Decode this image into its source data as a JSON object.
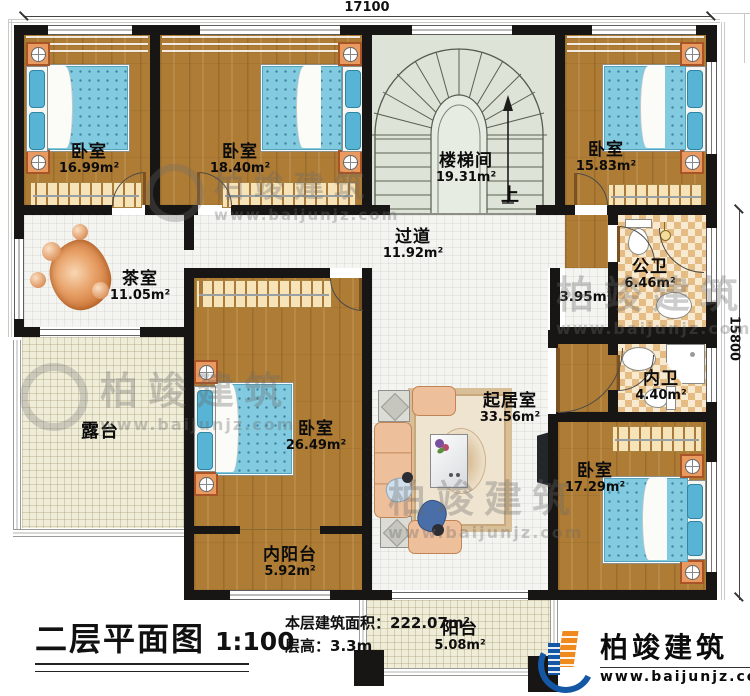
{
  "dimensions": {
    "top": "17100",
    "right": "15800"
  },
  "rooms": {
    "bedroom1": {
      "name": "卧室",
      "area": "16.99m²"
    },
    "bedroom2": {
      "name": "卧室",
      "area": "18.40m²"
    },
    "stairwell": {
      "name": "楼梯间",
      "area": "19.31m²",
      "up": "上"
    },
    "bedroom3": {
      "name": "卧室",
      "area": "15.83m²"
    },
    "tearoom": {
      "name": "茶室",
      "area": "11.05m²"
    },
    "hallway": {
      "name": "过道",
      "area": "11.92m²"
    },
    "nook": {
      "area": "3.95m²"
    },
    "public_bath": {
      "name": "公卫",
      "area": "6.46m²"
    },
    "terrace": {
      "name": "露台"
    },
    "bedroom4": {
      "name": "卧室",
      "area": "26.49m²"
    },
    "private_bath": {
      "name": "内卫",
      "area": "4.40m²"
    },
    "living": {
      "name": "起居室",
      "area": "33.56m²"
    },
    "bedroom5": {
      "name": "卧室",
      "area": "17.29m²"
    },
    "inner_balcony": {
      "name": "内阳台",
      "area": "5.92m²"
    },
    "balcony": {
      "name": "阳台",
      "area": "5.08m²"
    }
  },
  "titleblock": {
    "plan_title": "二层平面图",
    "scale": "1:100",
    "area_label": "本层建筑面积：",
    "area_value": "222.07m²",
    "height_label": "层高：",
    "height_value": "3.3m"
  },
  "brand": {
    "name": "柏竣建筑",
    "site": "www.baijunjz.com"
  },
  "watermark": {
    "name": "柏竣建筑",
    "site": "www.baijunjz.com"
  },
  "colors": {
    "wall": "#181614",
    "wood": "#ae7c35",
    "mattress": "#82cadf",
    "tile_checker": "#e5bd84",
    "brand_blue": "#1457a5",
    "brand_orange": "#f08a1d"
  }
}
